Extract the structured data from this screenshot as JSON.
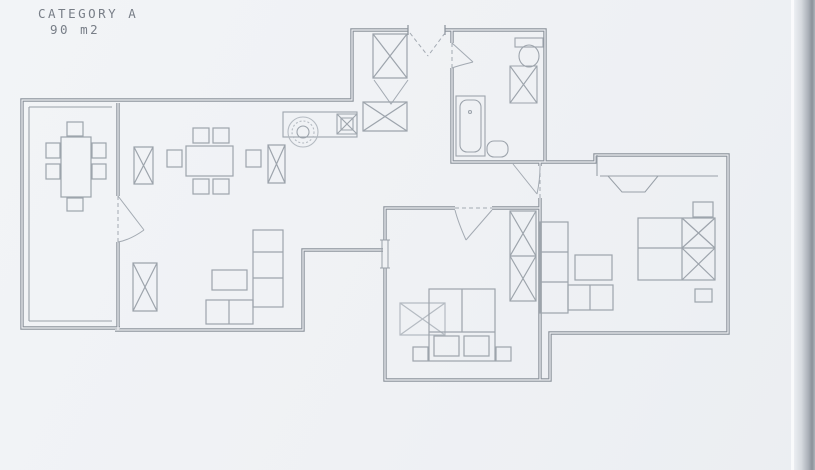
{
  "title": {
    "line1": "CATEGORY A",
    "line2": "90 m2"
  },
  "colors": {
    "background": "#eff1f4",
    "wall": "#8a919a",
    "inner_wall": "#99a0a8",
    "furniture": "#9da4ac",
    "light_detail": "#b5bbc2",
    "door": "#a3aab2",
    "text": "#787e87"
  },
  "floorplan": {
    "kind": "apartment-floor-plan",
    "category_label": "CATEGORY A",
    "area_label": "90 m2",
    "rooms": [
      {
        "name": "terrace",
        "furniture": [
          "table",
          "six-chairs"
        ]
      },
      {
        "name": "living-dining-room",
        "furniture": [
          "dining-table-six-chairs",
          "radiator",
          "radiator",
          "tv-cabinet",
          "coffee-table",
          "l-shaped-sofa"
        ]
      },
      {
        "name": "kitchen",
        "furniture": [
          "counter",
          "round-sink",
          "stove-unit"
        ]
      },
      {
        "name": "entrance-hall",
        "furniture": [
          "closet",
          "wardrobe"
        ]
      },
      {
        "name": "bathroom",
        "furniture": [
          "bathtub",
          "toilet",
          "shower-cabinet",
          "washbasin"
        ]
      },
      {
        "name": "bedroom-middle",
        "furniture": [
          "double-bed",
          "two-nightstands",
          "wardrobe",
          "dressing-table"
        ]
      },
      {
        "name": "bedroom-right",
        "furniture": [
          "double-bed",
          "two-nightstands",
          "shelf-unit",
          "desk",
          "dresser"
        ]
      }
    ]
  }
}
